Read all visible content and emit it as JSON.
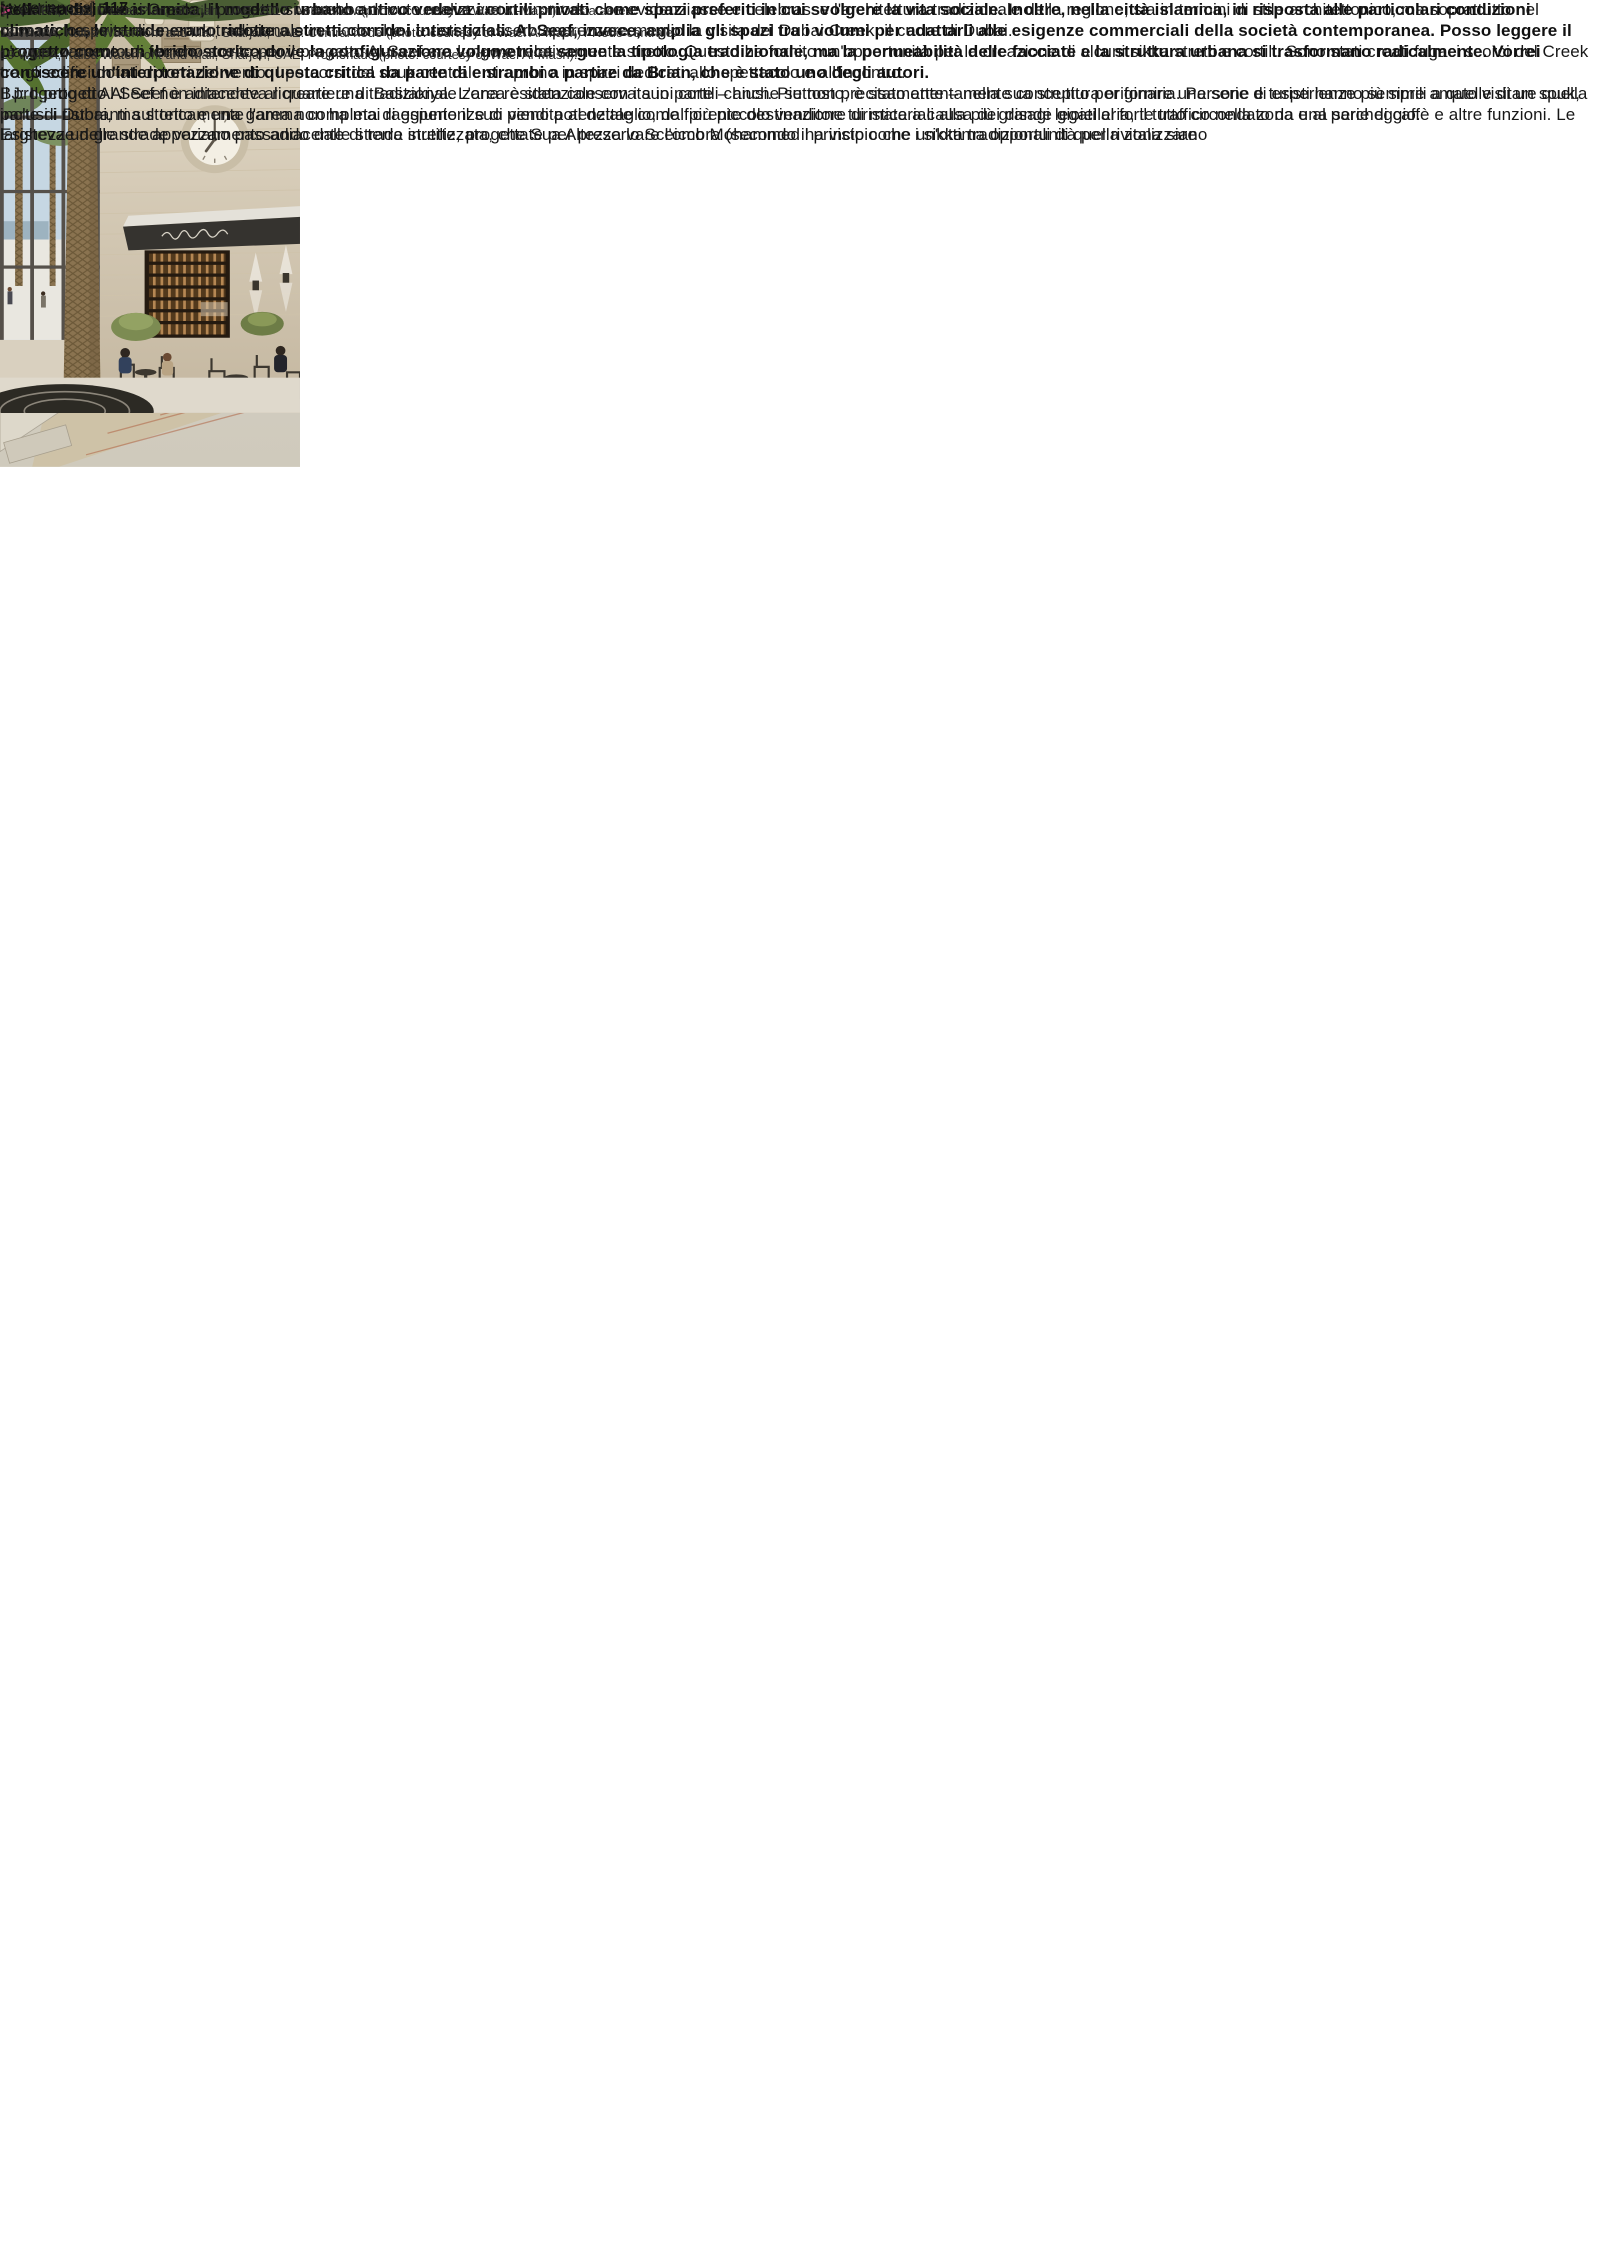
{
  "colors": {
    "accent_pink": "#c9447c",
    "body_text": "#171717",
    "page_background": "#ffffff"
  },
  "figures": {
    "promenade_label": "19"
  },
  "symbols": {
    "continuation_arrow": ">"
  },
  "article": {
    "question": "Nella tradizione islamica, il modello urbano antico vedeva i cortili privati come spazi preferiti in cui svolgere la vita sociale. Inoltre, nella città islamica, in risposta alle particolari condizioni climatiche, le strade erano ridotte a stretti corridoi interstiziali. Al Seef, invece, amplia gli spazi tra i volumi per adattarli alle esigenze commerciali della società contemporanea. Posso leggere il progetto come un ibrido storico dove la configurazione volumetrica segue la tipologia tradizionale, ma la permeabilità delle facciate e la struttura urbana si trasformano radicalmente. Vorrei conoscere un'interpretazione di questa critica da parte di entrambi a partire da Brian, che è stato uno degli autori.",
    "col1": [
      "BJ: Il progetto Al Seef è adiacente al quartiere di Bastakiya. L'area è stata conservata in parte – anche se non precisamente – nella sua struttura originaria. Persone e turisti hanno sempre amato visitare quella parte di Dubai, ma storicamente l'area non ha mai raggiunto il suo pieno potenziale come fiorente destinazione turistica a causa dei disagi legati al forte traffico nella zona e al parcheggio.",
      "Esisteva un grande appezzamento adiacente di terra inutilizzata, che Sua Altezza lo Sceicco Mohammed ha visto come un'ottima opportunità per rivitalizzare"
    ],
    "col2": [
      "quel lato del Dubai Creek. Il progetto si sarebbe dovuto realizzare in un modo che evidenziasse e celebrasse l'architettura tradizionale della regione, sia in termini di stile architettonico, ma soprattutto nel ricreare lo spirito di un souk tradizionale in modo che i turisti potessero apprezzare meglio la visita del Dubai Creek, il cuore di Dubai.",
      "L'appezzamento di terreno scelto per il progetto Al Seef era lungo e relativamente stretto. Questo ha fornito un'opportunità per la creazione di alcuni sikka stretti e cortili. Sono stati creati fugaci scorci del Creek tra gli edifici dotati di torri del vento. I percorsi del souk centrale si aprono in spazi dedicati allo spettacolo e all'incontro.",
      "Il progetto di Al Seef non intendeva ricreare una tradizionale zona residenziale con i suoi cortili chiusi. Piuttosto, è stato attentamente concepito per fornire una serie di esperienze più simili a quelle di un souk, inclusi i ristoranti sul tetto e una gamma completa di esperienze di vendita al dettaglio, dal più piccolo venditore di materiali alla più grande gioielleria, il tutto circondato da una serie di caffè e altre funzioni. Le larghezze delle strade variano passando dalle strade strette, progettate per preservare l'ombra (secondo il principio che i sikka tradizionali di quella zona siano"
    ]
  },
  "captions": [
    "17 WMPA, HOS Master Plan, Sharjah, UAE, 2017. Aerial view (photo: courtesy of Wael Al-Masri) / Vista aerea.",
    "18 WMPA, Kalba Waterfront and Mall, Sharjah, UAE. Central node (photo: courtesy of Wael Al-Masri) / Nodo centrale.",
    "19 WMPA, Kalba Waterfront and Mall, Sharjah, UAE. Promenade (photo: courtesy of Wael Al-Masri)."
  ],
  "footer": {
    "section": "[experiences]",
    "page": "117"
  }
}
